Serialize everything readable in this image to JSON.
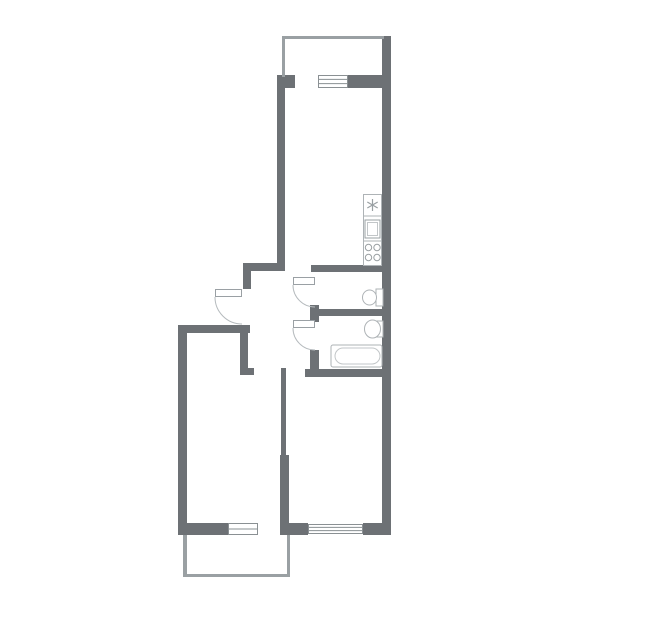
{
  "meta": {
    "title": "two-room-apartment-floor-plan",
    "canvas": {
      "width": 645,
      "height": 635
    },
    "visible_text": []
  },
  "colors": {
    "background": "#ffffff",
    "wall": "#6d7175",
    "light_wall": "#9aa0a3",
    "window_stroke": "#8a9093",
    "window_fill": "#ffffff",
    "door_leaf_stroke": "#9aa0a4",
    "door_leaf_fill": "#ffffff",
    "door_arc": "#b5babd",
    "fixture_stroke": "#aeb3b6",
    "fixture_inner_stroke": "#c2c6c8",
    "appliance_stroke": "#9aa0a3"
  },
  "floor_plan": {
    "walls": [
      {
        "name": "right-outer-wall",
        "x": 382,
        "y": 36,
        "w": 9,
        "h": 499,
        "kind": "main"
      },
      {
        "name": "top-wall-left-block",
        "x": 277,
        "y": 75,
        "w": 18,
        "h": 13,
        "kind": "main"
      },
      {
        "name": "top-wall-right-segment",
        "x": 348,
        "y": 75,
        "w": 34,
        "h": 13,
        "kind": "main"
      },
      {
        "name": "kitchen-left-wall",
        "x": 277,
        "y": 88,
        "w": 8,
        "h": 183,
        "kind": "main"
      },
      {
        "name": "hallway-top-wall",
        "x": 245,
        "y": 263,
        "w": 40,
        "h": 8,
        "kind": "main"
      },
      {
        "name": "entry-side-wall",
        "x": 243,
        "y": 263,
        "w": 8,
        "h": 26,
        "kind": "main"
      },
      {
        "name": "bedroom-top-wall",
        "x": 178,
        "y": 325,
        "w": 72,
        "h": 8,
        "kind": "main"
      },
      {
        "name": "left-outer-wall",
        "x": 178,
        "y": 325,
        "w": 9,
        "h": 210,
        "kind": "main"
      },
      {
        "name": "hallway-west-wall",
        "x": 240,
        "y": 333,
        "w": 8,
        "h": 35,
        "kind": "main"
      },
      {
        "name": "hallway-west-wall-foot",
        "x": 240,
        "y": 368,
        "w": 14,
        "h": 7,
        "kind": "main"
      },
      {
        "name": "room-divider-wall-upper",
        "x": 281,
        "y": 368,
        "w": 5,
        "h": 87,
        "kind": "main"
      },
      {
        "name": "room-divider-wall-lower",
        "x": 280,
        "y": 455,
        "w": 9,
        "h": 80,
        "kind": "main"
      },
      {
        "name": "wc-top-wall",
        "x": 311,
        "y": 265,
        "w": 71,
        "h": 7,
        "kind": "main"
      },
      {
        "name": "wc-door-jamb-block",
        "x": 310,
        "y": 305,
        "w": 9,
        "h": 17,
        "kind": "main"
      },
      {
        "name": "wc-bathroom-divider-wall",
        "x": 310,
        "y": 309,
        "w": 72,
        "h": 7,
        "kind": "main"
      },
      {
        "name": "bathroom-door-jamb-block",
        "x": 310,
        "y": 350,
        "w": 9,
        "h": 27,
        "kind": "main"
      },
      {
        "name": "bathroom-bottom-wall",
        "x": 305,
        "y": 369,
        "w": 77,
        "h": 8,
        "kind": "main"
      },
      {
        "name": "bedroom-bottom-wall",
        "x": 178,
        "y": 523,
        "w": 50,
        "h": 12,
        "kind": "main"
      },
      {
        "name": "living-bottom-wall-left",
        "x": 280,
        "y": 523,
        "w": 28,
        "h": 12,
        "kind": "main"
      },
      {
        "name": "living-bottom-wall-right",
        "x": 363,
        "y": 523,
        "w": 28,
        "h": 12,
        "kind": "main"
      },
      {
        "name": "top-balcony-top-wall",
        "x": 282,
        "y": 36,
        "w": 102,
        "h": 3,
        "kind": "light"
      },
      {
        "name": "top-balcony-left-wall",
        "x": 282,
        "y": 36,
        "w": 3,
        "h": 41,
        "kind": "light"
      },
      {
        "name": "bottom-balcony-left-wall",
        "x": 183,
        "y": 535,
        "w": 4,
        "h": 42,
        "kind": "light"
      },
      {
        "name": "bottom-balcony-bottom-wall",
        "x": 183,
        "y": 574,
        "w": 107,
        "h": 3,
        "kind": "light"
      },
      {
        "name": "bottom-balcony-right-wall",
        "x": 287,
        "y": 535,
        "w": 3,
        "h": 42,
        "kind": "light"
      }
    ],
    "windows": [
      {
        "name": "kitchen-balcony-window",
        "x": 318,
        "y": 75,
        "w": 30,
        "h": 13,
        "inner_lines": 2
      },
      {
        "name": "bedroom-window",
        "x": 228,
        "y": 523,
        "w": 30,
        "h": 12,
        "inner_lines": 1
      },
      {
        "name": "living-room-window",
        "x": 308,
        "y": 524,
        "w": 55,
        "h": 10,
        "inner_lines": 2
      }
    ],
    "doors": [
      {
        "name": "entry-door",
        "leaf": {
          "x": 215,
          "y": 289,
          "w": 27,
          "h": 8
        },
        "arc": {
          "x1": 215,
          "y1": 297,
          "r": 27,
          "x2": 242,
          "y2": 324
        }
      },
      {
        "name": "wc-door",
        "leaf": {
          "x": 293,
          "y": 277,
          "w": 22,
          "h": 8
        },
        "arc": {
          "x1": 293,
          "y1": 285,
          "r": 22,
          "x2": 315,
          "y2": 307
        }
      },
      {
        "name": "bathroom-door",
        "leaf": {
          "x": 293,
          "y": 320,
          "w": 22,
          "h": 8
        },
        "arc": {
          "x1": 293,
          "y1": 328,
          "r": 22,
          "x2": 315,
          "y2": 350
        }
      }
    ],
    "openings": [
      {
        "name": "balcony-door-opening-top",
        "x": 295,
        "y": 75,
        "w": 23
      },
      {
        "name": "kitchen-entrance-opening",
        "x": 285,
        "y": 263,
        "w": 26
      },
      {
        "name": "bedroom-entrance-opening",
        "x": 254,
        "y": 368,
        "w": 27
      },
      {
        "name": "living-room-entrance-opening",
        "x": 286,
        "y": 369,
        "w": 19
      },
      {
        "name": "balcony-door-opening-bottom",
        "x": 258,
        "y": 523,
        "w": 22
      }
    ],
    "fixtures": {
      "kitchen_counter": {
        "x": 363,
        "y": 194,
        "w": 19,
        "h": 72,
        "dividers_y": [
          216,
          241
        ]
      },
      "refrigerator": {
        "cx": 372.5,
        "cy": 205,
        "r": 6
      },
      "kitchen_sink": {
        "outer": {
          "x": 365,
          "y": 220,
          "w": 15,
          "h": 18
        },
        "inner": {
          "x": 367.5,
          "y": 222.5,
          "w": 10,
          "h": 13
        }
      },
      "stove": {
        "r": 3.2,
        "burners": [
          [
            368.5,
            247.5
          ],
          [
            377,
            247.5
          ],
          [
            368.5,
            257.5
          ],
          [
            377,
            257.5
          ]
        ]
      },
      "toilet": {
        "tank": {
          "x": 376,
          "y": 289,
          "w": 7,
          "h": 17
        },
        "bowl": {
          "cx": 369.5,
          "cy": 297.5,
          "rx": 7,
          "ry": 7.5
        }
      },
      "washbasin": {
        "back": {
          "x": 377,
          "y": 321,
          "w": 6,
          "h": 16
        },
        "bowl": {
          "cx": 372.5,
          "cy": 329,
          "rx": 8,
          "ry": 9
        }
      },
      "bathtub": {
        "outer": {
          "x": 331,
          "y": 345,
          "w": 51,
          "h": 22,
          "rx": 2
        },
        "inner": {
          "x": 335,
          "y": 348,
          "w": 45,
          "h": 16,
          "rx": 8
        }
      }
    },
    "rooms": [
      {
        "name": "balcony-top",
        "x": 285,
        "y": 39,
        "w": 97,
        "h": 36
      },
      {
        "name": "kitchen",
        "x": 285,
        "y": 88,
        "w": 97,
        "h": 177
      },
      {
        "name": "hallway",
        "x": 251,
        "y": 271,
        "w": 59,
        "h": 97
      },
      {
        "name": "wc",
        "x": 319,
        "y": 272,
        "w": 63,
        "h": 37
      },
      {
        "name": "bathroom",
        "x": 319,
        "y": 316,
        "w": 63,
        "h": 53
      },
      {
        "name": "bedroom",
        "x": 187,
        "y": 333,
        "w": 94,
        "h": 190
      },
      {
        "name": "living-room",
        "x": 289,
        "y": 377,
        "w": 93,
        "h": 146
      },
      {
        "name": "balcony-bottom",
        "x": 187,
        "y": 535,
        "w": 100,
        "h": 39
      }
    ]
  }
}
